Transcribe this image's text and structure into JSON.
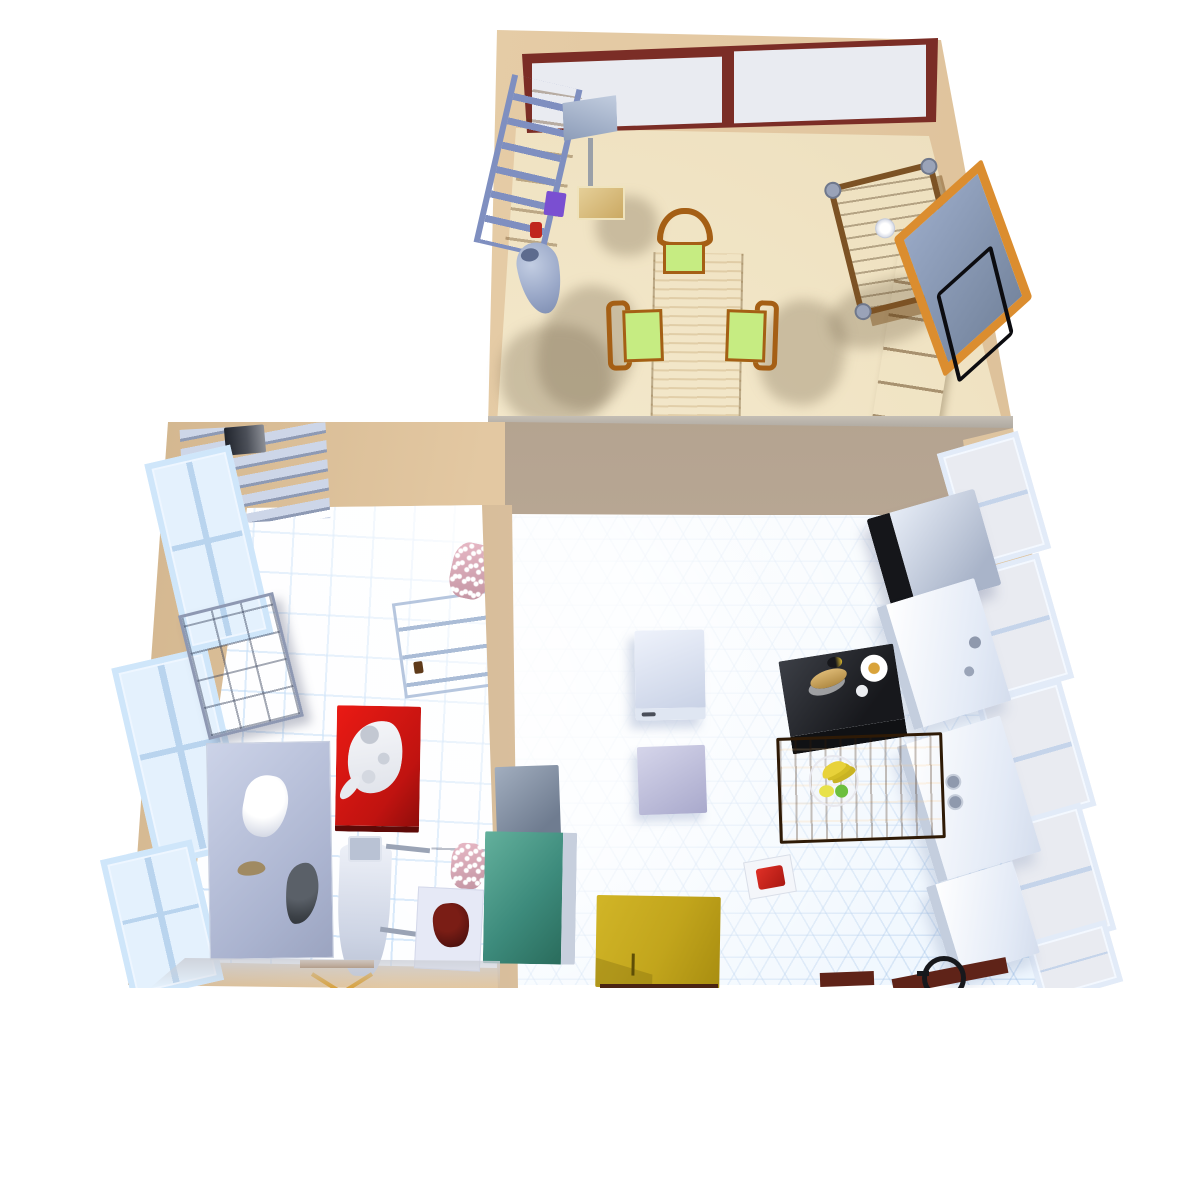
{
  "scene": {
    "title": "Top-down 3D render of a three-room apartment",
    "style": "simulated 3D home interior, isometric top-down view",
    "background": "#ffffff"
  },
  "colors": {
    "bg": "#ffffff",
    "wall": "#e3c8a2",
    "wall-dark": "#d2b48c",
    "maroon": "#7b2d26",
    "glass": "#e9ebf1",
    "dining-floor": "#f0e3c3",
    "winblue": "#cfe6fa",
    "winglass": "#e4f1fd",
    "ladder": "#7f8fc0",
    "purple": "#7a4fd1",
    "vase": "#9aa8c8",
    "cushion": "#c6ec82",
    "chair-wood": "#a55f15",
    "board-frame": "#db8d2f",
    "red": "#ea1a14",
    "pink": "#e8b9c6",
    "dk-red": "#5a1410",
    "black": "#17181c",
    "teal": "#3d8b7c",
    "mustard": "#c2a51c",
    "banana": "#e8d23a",
    "baseboard": "#5f2318"
  },
  "rooms": {
    "dining": {
      "label": "Dining room",
      "objects": {
        "window_band": "Long casement window, maroon frame",
        "step_ladder": "Blue step ladder leaning on wall",
        "bookshelf": "Pine shelf unit",
        "purple_box": "Purple box on shelf",
        "red_toy": "Small red object",
        "floor_vase": "Blue-grey floor vase",
        "floor_lamp": "Floor lamp with square grey shade",
        "dining_table": "Light wood dining table",
        "chair_top": "Wooden chair with green cushion (head of table)",
        "chair_left": "Wooden chair with green cushion (left)",
        "chair_right": "Wooden chair with green cushion (right)",
        "serving_cart": "Wooden serving cart with wheels",
        "wine_glass": "White wine glass on cart",
        "dresser": "Wooden dresser along right wall",
        "blackboard": "Blackboard with orange frame leaning on wall",
        "wire_frame": "Black wire wall frame"
      }
    },
    "laundry": {
      "label": "Laundry / utility room",
      "objects": {
        "ladder_shelf": "Tiered wall shelf",
        "shelf_book": "Dark book on shelf",
        "window_1": "Wall window (upper left)",
        "window_2": "Wall window (middle left)",
        "window_3": "Wall window (lower left)",
        "cubby_shelf": "Grey cubby shelf unit",
        "work_table": "Large grey work table",
        "towel": "White crumpled towel",
        "figurine": "Small animal figurine",
        "clothes_pile": "Dark clothes pile",
        "red_side_table": "Red side table",
        "cat": "White cat lying on red table",
        "ironing_board": "Ironing board",
        "iron_rest": "Iron rest pad",
        "clothes_hanger": "Wooden clothes hanger on rail",
        "open_door": "Open white panel door",
        "laundry_bag_upper": "Pink polka-dot laundry bag (upper)",
        "laundry_bag_lower": "Pink polka-dot laundry bag (lower)",
        "tall_cabinet": "Grey cabinet by divider wall",
        "side_stand": "White side stand",
        "leather_bag": "Dark red leather bag on stand"
      }
    },
    "kitchen": {
      "label": "Kitchen",
      "objects": {
        "dishwasher": "White free-standing appliance",
        "cabinet_box": "Lavender cabinet box",
        "prep_table": "Black prep table with bread, plate and egg",
        "bread": "Bread loaf",
        "plate": "White plate with food",
        "egg": "Egg",
        "island_table": "Wooden island table",
        "fruit_bowl": "Fruit bowl with bananas, lemon and green apple",
        "microwave": "Microwave on counter, black door",
        "counter_faucet": "White counter with faucet",
        "counter_stove": "White counter with two knobs",
        "counter_low": "White counter (lower)",
        "window_1": "Right-wall window 1",
        "window_2": "Right-wall window 2",
        "window_3": "Right-wall window 3",
        "window_4": "Right-wall window 4",
        "window_5": "Right-wall window 5",
        "teal_stove": "Teal enamel stove",
        "utility_box": "Grey utility appliance",
        "yellow_table": "Mustard-yellow table",
        "napkin_red_cloth": "White napkin with red cloth",
        "kettle": "Black kettle at bottom edge",
        "baseboard": "Maroon baseboard strips"
      }
    }
  }
}
